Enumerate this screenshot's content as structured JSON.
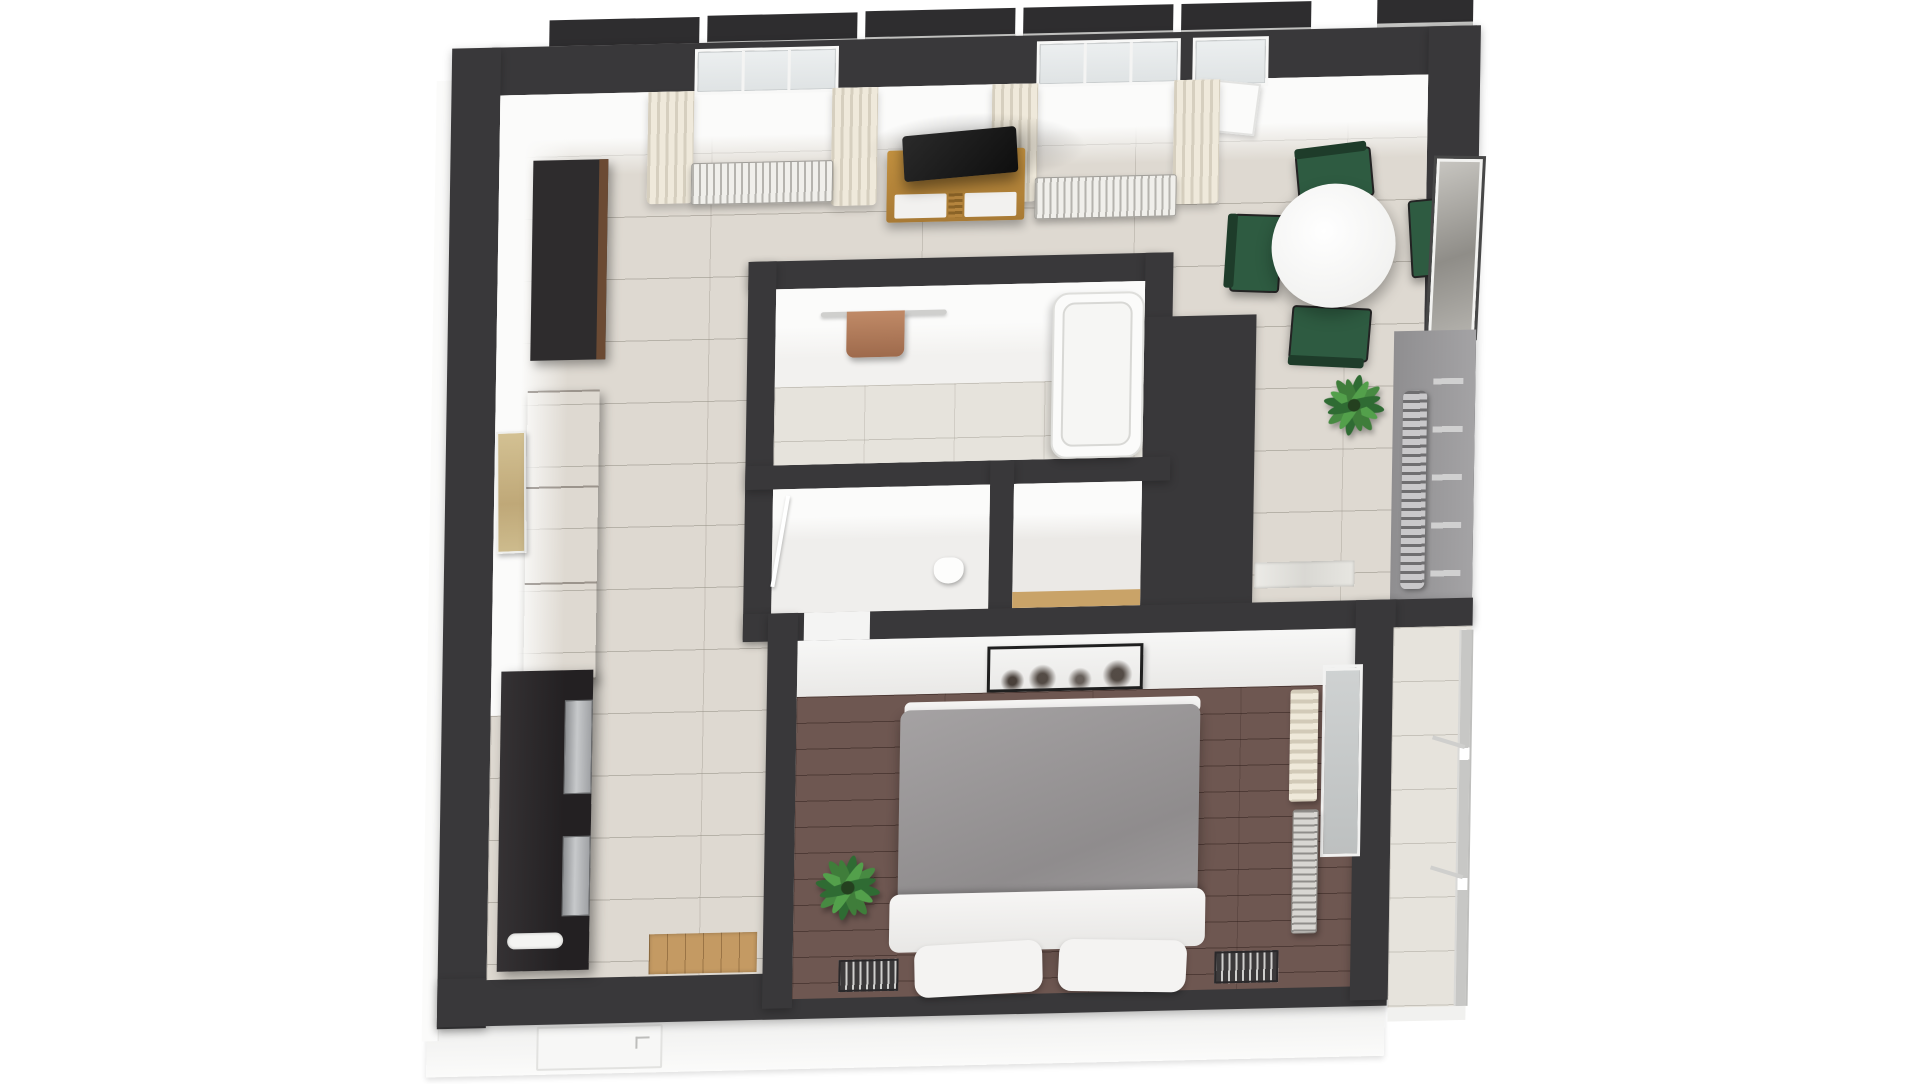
{
  "scene": {
    "type": "3d-floor-plan-top-view",
    "background_color": "#ffffff",
    "wall_color": "#39383a",
    "tilt_deg": -1.3,
    "visible_text": "none"
  },
  "palette": {
    "tile_floor": "#ded9d1",
    "bedroom_wood_floor": "#6e5751",
    "curtain_cream": "#e7e1d2",
    "radiator_white": "#f0efeb",
    "chair_green": "#2e5b41",
    "table_white": "#f4f4f3",
    "tv_black": "#161616",
    "tv_stand_wood": "#b5853e",
    "wardrobe_brown": "#6b4730",
    "kitchen_counter_dark": "#2b282a",
    "duvet_gray": "#9c999a",
    "linen_white": "#f2f1ef",
    "plant_green": "#3f7d3a",
    "towel_brown": "#b07c5e",
    "balcony_floor": "#d9d7d2"
  },
  "exterior": {
    "window_head_segments": 6,
    "entry_door": {
      "side": "bottom-left",
      "color": "#f7f7f6"
    },
    "left_and_bottom_wall_faces": "white"
  },
  "rooms": [
    {
      "id": "living-dining",
      "label": "living room / dining area / kitchen",
      "floor": "light tile",
      "furniture": [
        "window-1",
        "window-2",
        "balcony-door",
        "curtains-4-panels",
        "radiator-under-window-1",
        "radiator-under-window-2",
        "tv",
        "tv-stand-wood-two-white-drawers",
        "round-dining-table-white",
        "dining-chairs-green-x4",
        "wall-art-dining-gray",
        "potted-plant",
        "tall-dark-cabinet",
        "brown-wardrobe",
        "wall-art-tan",
        "dark-kitchen-counter",
        "steel-appliance-fronts-x2",
        "white-sink",
        "entry-doormat-wood",
        "towel-radiator-on-gray-wall"
      ]
    },
    {
      "id": "bathroom",
      "label": "bathroom",
      "floor": "white + light tile",
      "furniture": [
        "towel-rail-chrome",
        "towel-brown",
        "bathtub-white"
      ]
    },
    {
      "id": "wc",
      "label": "small wc room",
      "floor": "white tile",
      "furniture": [
        "toilet-white",
        "door-leaf-open"
      ]
    },
    {
      "id": "closet",
      "label": "hallway closet",
      "floor": "white with wood threshold",
      "furniture": []
    },
    {
      "id": "bedroom",
      "label": "bedroom",
      "floor": "dark brown wood planks",
      "furniture": [
        "double-bed-gray-duvet",
        "white-fold-sheet",
        "pillows-white-x2",
        "nightstand-left",
        "nightstand-right",
        "panoramic-picture-sepia",
        "potted-plant",
        "window-east",
        "curtain-east-beige",
        "radiator-east",
        "marble-doormat",
        "dark-storage-column"
      ]
    },
    {
      "id": "balcony",
      "label": "balcony",
      "floor": "light tile",
      "furniture": [
        "glass-metal-railing"
      ]
    }
  ]
}
